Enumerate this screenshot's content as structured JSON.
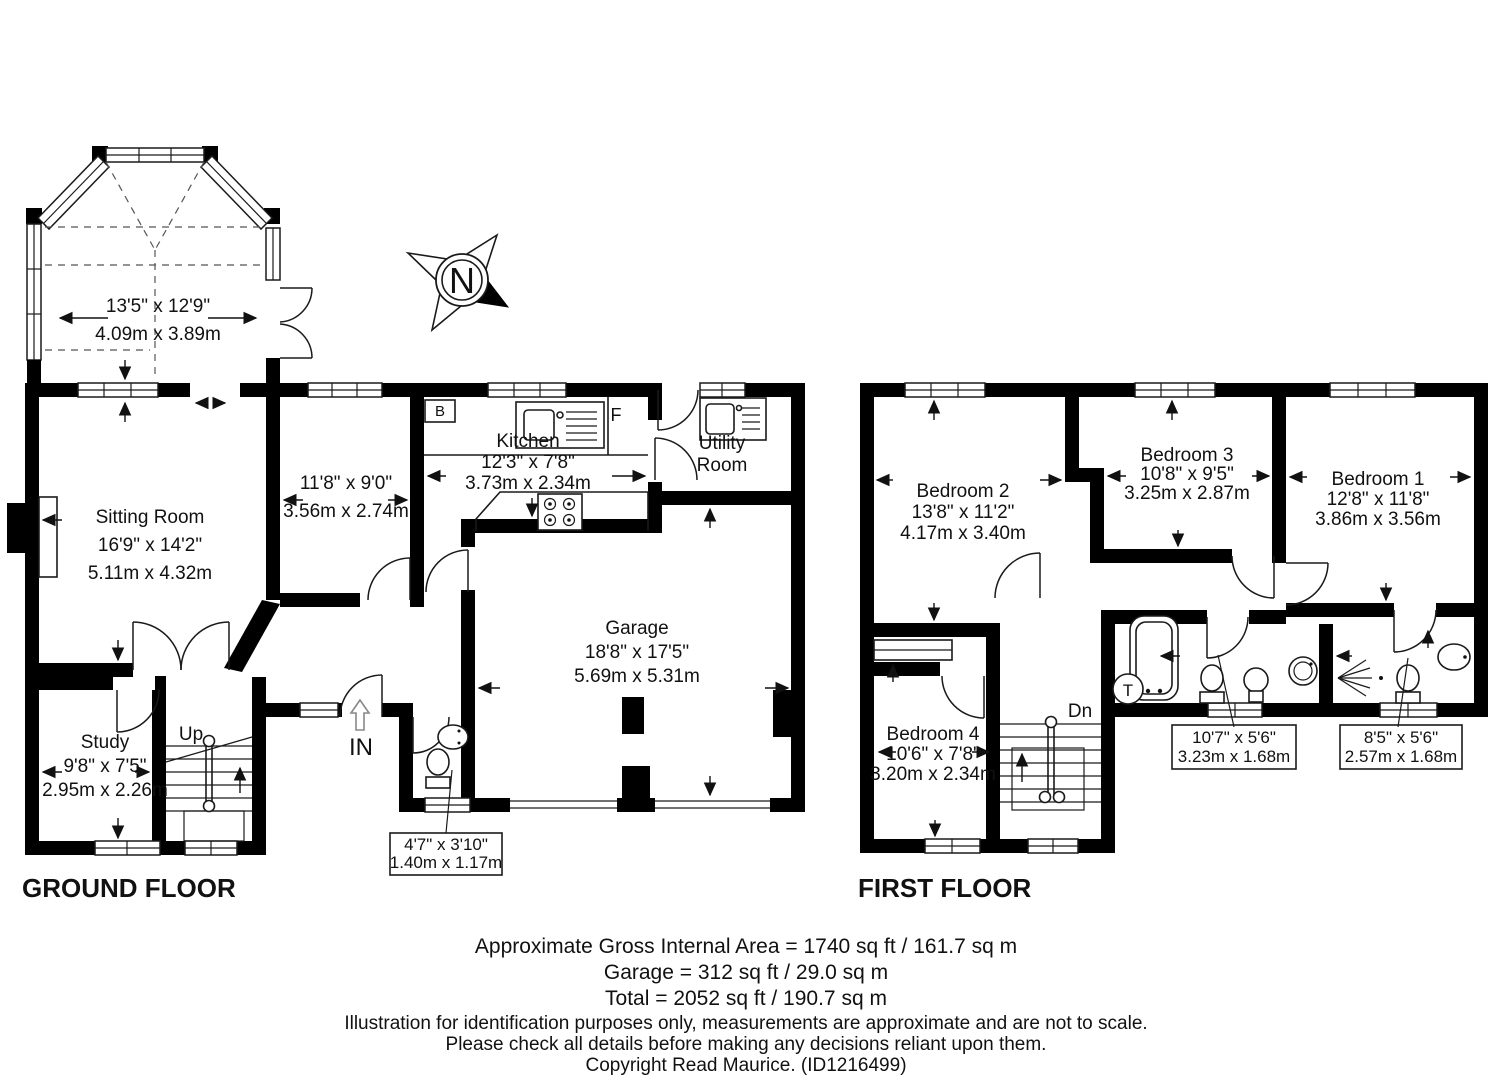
{
  "ground_floor": {
    "title": "GROUND FLOOR",
    "bay_room": {
      "imperial": "13'5\" x 12'9\"",
      "metric": "4.09m x 3.89m"
    },
    "sitting_room": {
      "name": "Sitting Room",
      "imperial": "16'9\" x 14'2\"",
      "metric": "5.11m x 4.32m"
    },
    "dining_room": {
      "imperial": "11'8\" x 9'0\"",
      "metric": "3.56m x 2.74m"
    },
    "kitchen": {
      "name": "Kitchen",
      "imperial": "12'3\" x 7'8\"",
      "metric": "3.73m x 2.34m"
    },
    "utility_room": {
      "name_line1": "Utility",
      "name_line2": "Room"
    },
    "garage": {
      "name": "Garage",
      "imperial": "18'8\" x 17'5\"",
      "metric": "5.69m x 5.31m"
    },
    "study": {
      "name": "Study",
      "imperial": "9'8\" x 7'5\"",
      "metric": "2.95m x 2.26m"
    },
    "wc": {
      "imperial": "4'7\" x 3'10\"",
      "metric": "1.40m x 1.17m"
    },
    "labels": {
      "up": "Up",
      "entrance": "IN",
      "boiler": "B",
      "fridge": "F"
    }
  },
  "first_floor": {
    "title": "FIRST FLOOR",
    "bedroom_1": {
      "name": "Bedroom 1",
      "imperial": "12'8\" x 11'8\"",
      "metric": "3.86m x 3.56m"
    },
    "bedroom_2": {
      "name": "Bedroom 2",
      "imperial": "13'8\" x 11'2\"",
      "metric": "4.17m x 3.40m"
    },
    "bedroom_3": {
      "name": "Bedroom 3",
      "imperial": "10'8\" x 9'5\"",
      "metric": "3.25m x 2.87m"
    },
    "bedroom_4": {
      "name": "Bedroom 4",
      "imperial": "10'6\" x 7'8\"",
      "metric": "3.20m x 2.34m"
    },
    "bathroom": {
      "imperial": "10'7\" x 5'6\"",
      "metric": "3.23m x 1.68m"
    },
    "ensuite": {
      "imperial": "8'5\" x 5'6\"",
      "metric": "2.57m x 1.68m"
    },
    "labels": {
      "down": "Dn",
      "tank": "T"
    }
  },
  "compass": {
    "north": "N"
  },
  "footer": {
    "area_line_1": "Approximate Gross Internal Area = 1740 sq ft / 161.7 sq m",
    "area_line_2": "Garage = 312 sq ft / 29.0 sq m",
    "area_line_3": "Total = 2052 sq ft / 190.7 sq m",
    "disclaimer_line_1": "Illustration for identification purposes only, measurements are approximate and are not to scale.",
    "disclaimer_line_2": "Please check all details before making any decisions reliant upon them.",
    "copyright": "Copyright Read Maurice. (ID1216499)"
  },
  "colors": {
    "wall": "#000000",
    "background": "#ffffff",
    "line": "#1a1a1a"
  }
}
